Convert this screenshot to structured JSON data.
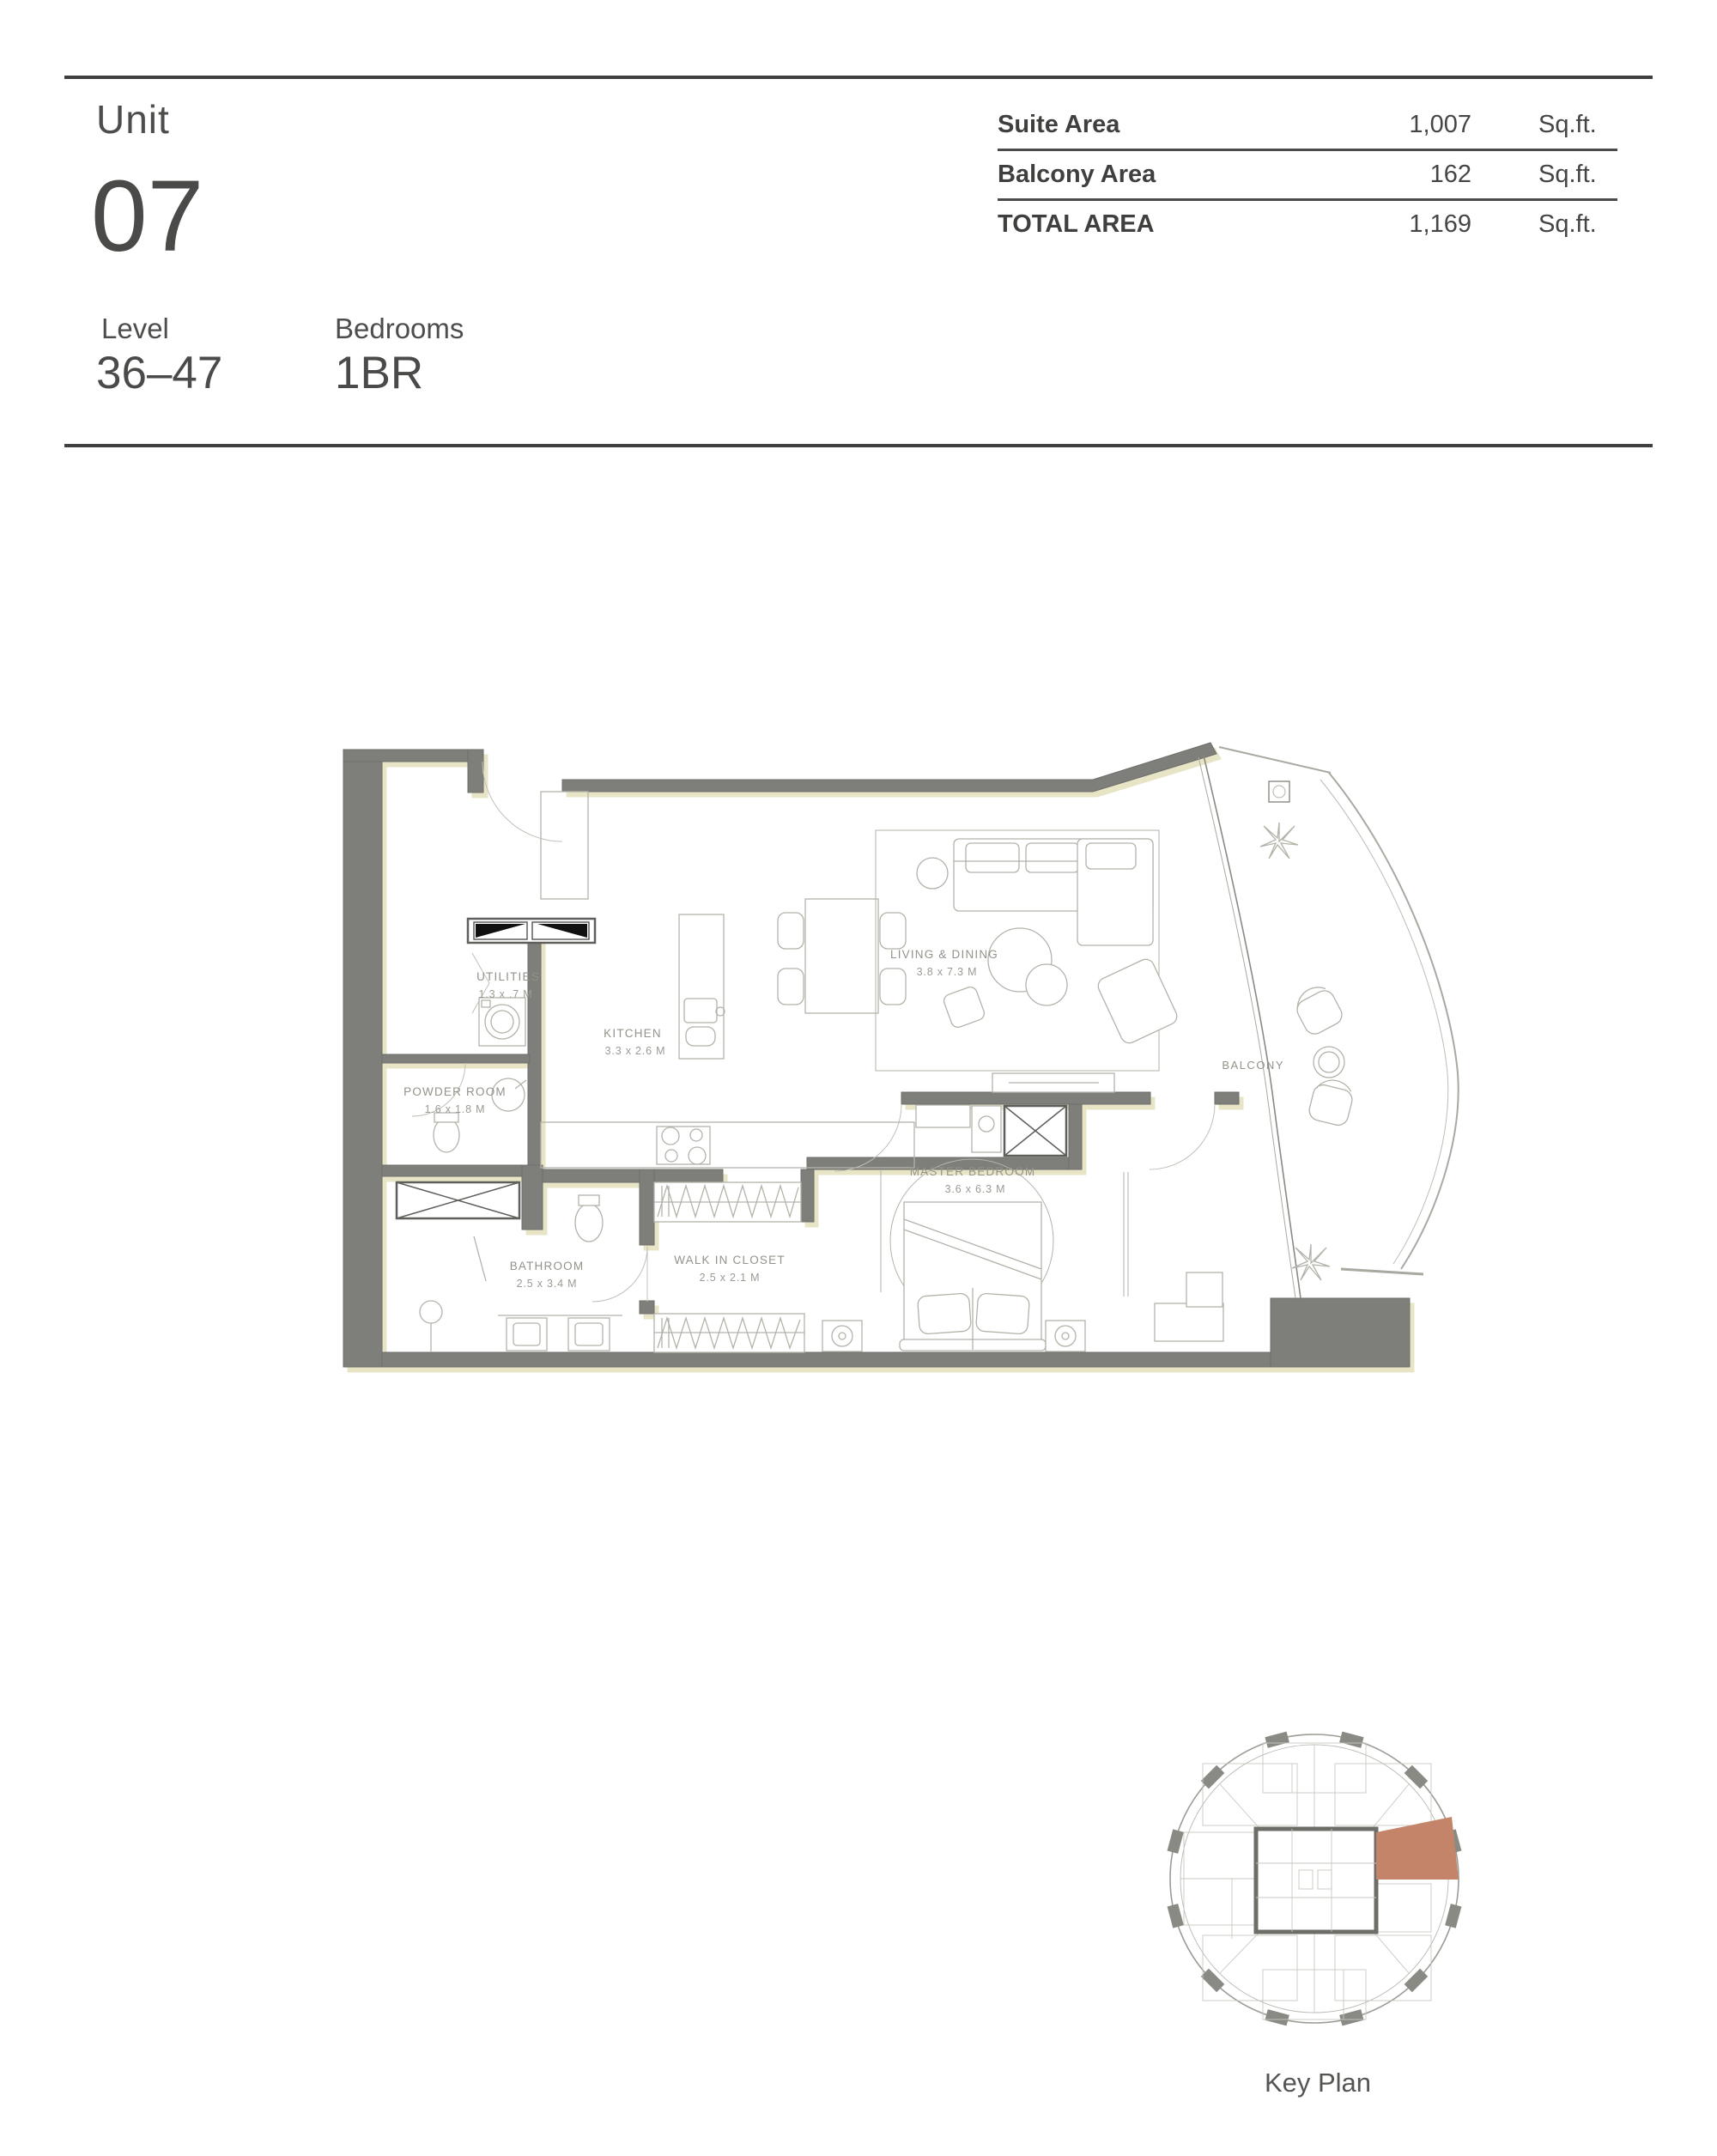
{
  "header": {
    "unit_label": "Unit",
    "unit_number": "07",
    "level_label": "Level",
    "level_value": "36–47",
    "bedrooms_label": "Bedrooms",
    "bedrooms_value": "1BR"
  },
  "area_table": {
    "rows": [
      {
        "label": "Suite Area",
        "value": "1,007",
        "unit": "Sq.ft."
      },
      {
        "label": "Balcony Area",
        "value": "162",
        "unit": "Sq.ft."
      },
      {
        "label": "TOTAL AREA",
        "value": "1,169",
        "unit": "Sq.ft."
      }
    ]
  },
  "floor_plan": {
    "rooms": [
      {
        "name": "UTILITIES",
        "dims": "1.3 x .7 M"
      },
      {
        "name": "KITCHEN",
        "dims": "3.3 x 2.6 M"
      },
      {
        "name": "POWDER ROOM",
        "dims": "1.6 x 1.8 M"
      },
      {
        "name": "LIVING & DINING",
        "dims": "3.8 x 7.3 M"
      },
      {
        "name": "MASTER BEDROOM",
        "dims": "3.6 x 6.3 M"
      },
      {
        "name": "BATHROOM",
        "dims": "2.5 x 3.4 M"
      },
      {
        "name": "WALK IN CLOSET",
        "dims": "2.5 x 2.1 M"
      }
    ],
    "balcony_label": "BALCONY"
  },
  "key_plan": {
    "caption": "Key Plan",
    "highlight_color": "#c48469"
  },
  "colors": {
    "wall": "#7e7e7a",
    "rule": "#3f3f3e",
    "text_dark": "#4a4a48",
    "text_gray": "#93938b",
    "wall_shadow": "#e8e5c6"
  }
}
